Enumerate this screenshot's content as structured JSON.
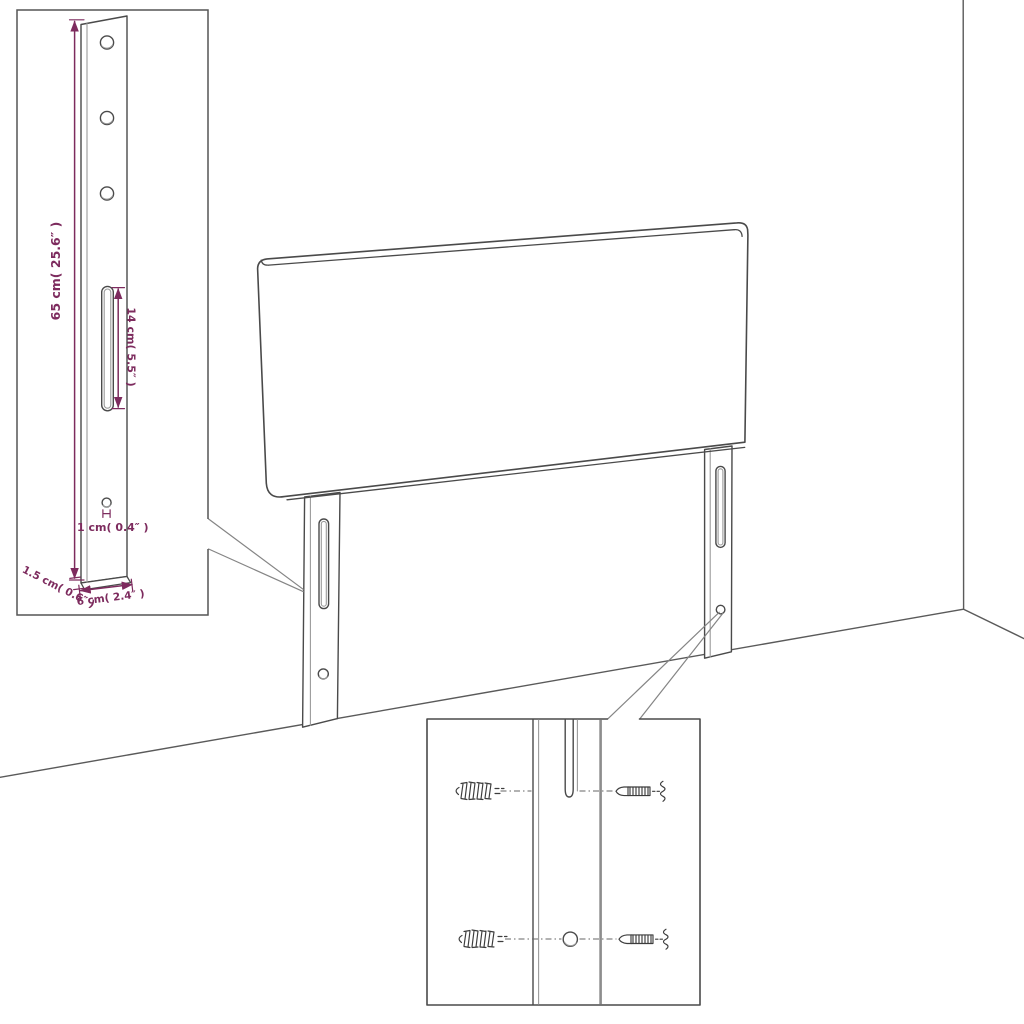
{
  "diagram": {
    "type": "furniture-dimension-diagram",
    "subject": "Headboard with two slotted mounting legs shown in a room corner",
    "views": {
      "main": "headboard with two legs",
      "inset_leg": "enlarged leg with holes and slot",
      "inset_mounting": "enlarged lower leg with wall plugs and screws"
    },
    "labels": {
      "height": "65 cm( 25.6″ )",
      "slot_length": "14 cm( 5.5″ )",
      "hole_diameter": "1 cm( 0.4″ )",
      "thickness": "1.5 cm( 0.6″ )",
      "leg_width": "6 cm( 2.4″ )"
    },
    "colors": {
      "dimension_accent": "#7d2b5e",
      "outline": "#4a4a4a",
      "background": "#ffffff"
    }
  }
}
